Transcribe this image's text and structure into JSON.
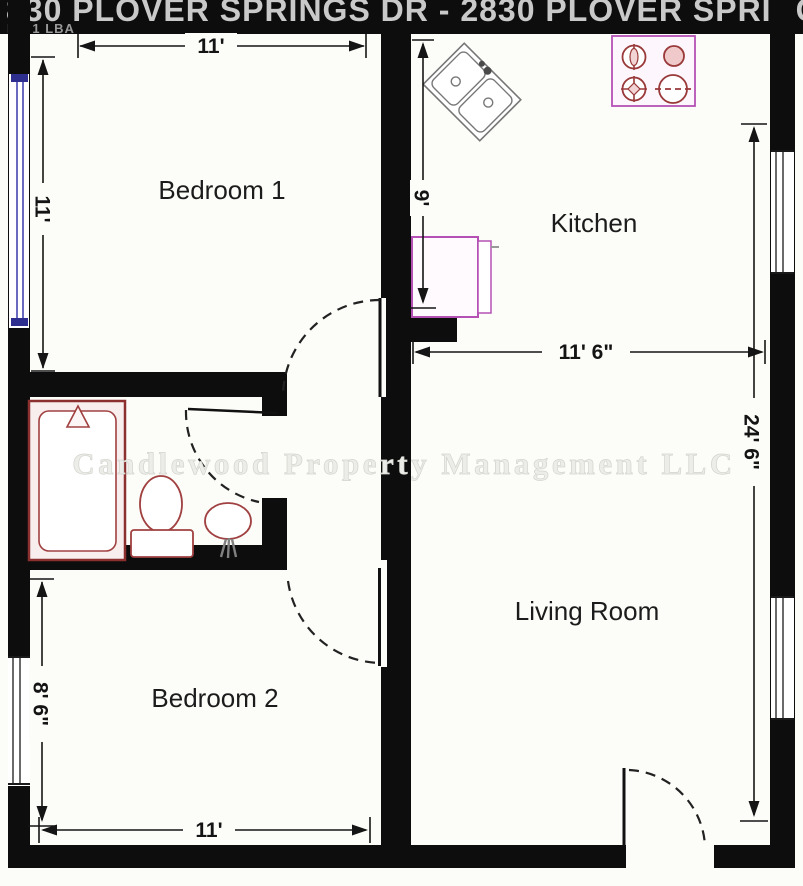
{
  "header": {
    "title": "830 PLOVER SPRINGS DR - 2830 PLOVER SPRINGS",
    "subtitle": "BR 1 LBA"
  },
  "watermark": "Candlewood Property Management LLC",
  "rooms": {
    "bedroom1": "Bedroom 1",
    "kitchen": "Kitchen",
    "living_room": "Living Room",
    "bedroom2": "Bedroom 2"
  },
  "dimensions": {
    "bedroom1_width": "11'",
    "bedroom1_depth": "11'",
    "kitchen_depth": "9'",
    "kitchen_width": "11' 6\"",
    "overall_right_depth": "24' 6\"",
    "bedroom2_depth": "8' 6\"",
    "bedroom2_width": "11'"
  },
  "colors": {
    "wall": "#0d0d0d",
    "appliance_outline": "#b551b5",
    "burner_outline": "#993939",
    "bath_fixture_outline": "#a04040",
    "window_accent": "#2e2e8e",
    "dimension": "#151515",
    "title_text": "#c9c9c9"
  }
}
